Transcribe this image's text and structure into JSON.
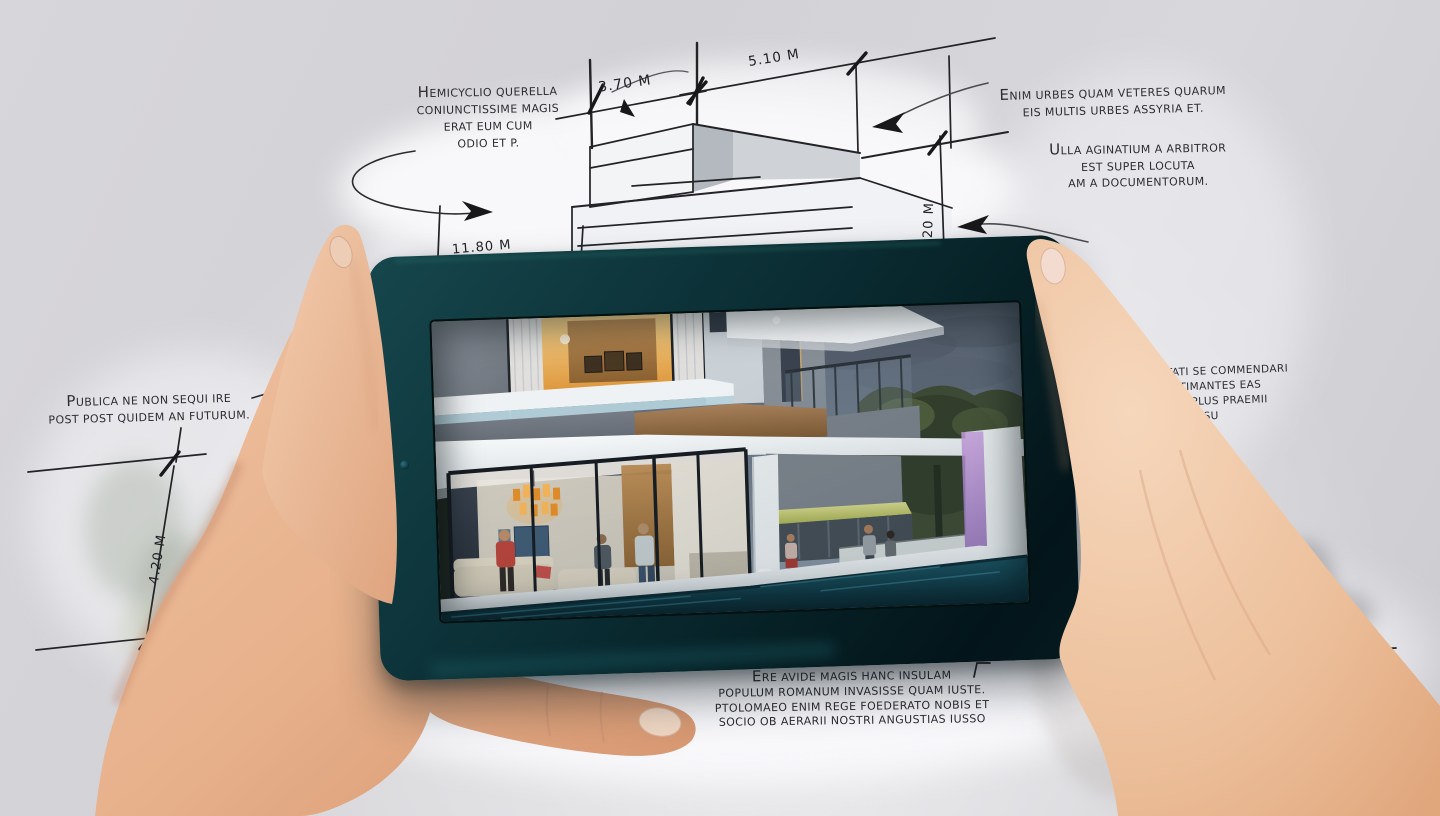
{
  "annotations": {
    "top_left": "HEMICYCLIO QUERELLA\nCONIUNCTISSIME MAGIS\nERAT EUM CUM\nODIO ET P.",
    "top_right": "ENIM URBES QUAM VETERES QUARUM\nEIS MULTIS URBES ASSYRIA ET.",
    "right_upper": "ULLA AGINATIUM A ARBITROR\nEST SUPER LOCUTA\nAM A DOCUMENTORUM.",
    "left": "PUBLICA NE NON SEQUI IRE\nPOST POST QUIDEM AN FUTURUM.",
    "right_partial": "ITATI SE COMMENDARI\n ESTIMANTES EAS\n  ASI PLUS PRAEMII\n     SENSU\n       BU,",
    "bottom": "ERE AVIDE MAGIS HANC INSULAM\nPOPULUM ROMANUM INVASISSE QUAM IUSTE.\nPTOLOMAEO ENIM REGE FOEDERATO NOBIS ET\nSOCIO OB AERARII NOSTRI ANGUSTIAS IUSSO"
  },
  "dimensions": {
    "top_width_left": "3.70 M",
    "top_width_right": "5.10 M",
    "right_height": "4.20 M",
    "middle_width": "11.80 M",
    "left_height": "4.20 M"
  },
  "colors": {
    "background_gray": "#d2d1d5",
    "paper_white": "#f6f6f8",
    "sketch_ink": "#232327",
    "tablet_bezel_teal": "#0e3338",
    "skin_tone": "#e9b895",
    "screen_dusk_sky": "#74818f",
    "warm_interior_light": "#e8a94e",
    "pool_teal": "#1c4f5c",
    "purple_column_light": "#b287d2",
    "foliage_green": "#3e4a33"
  }
}
